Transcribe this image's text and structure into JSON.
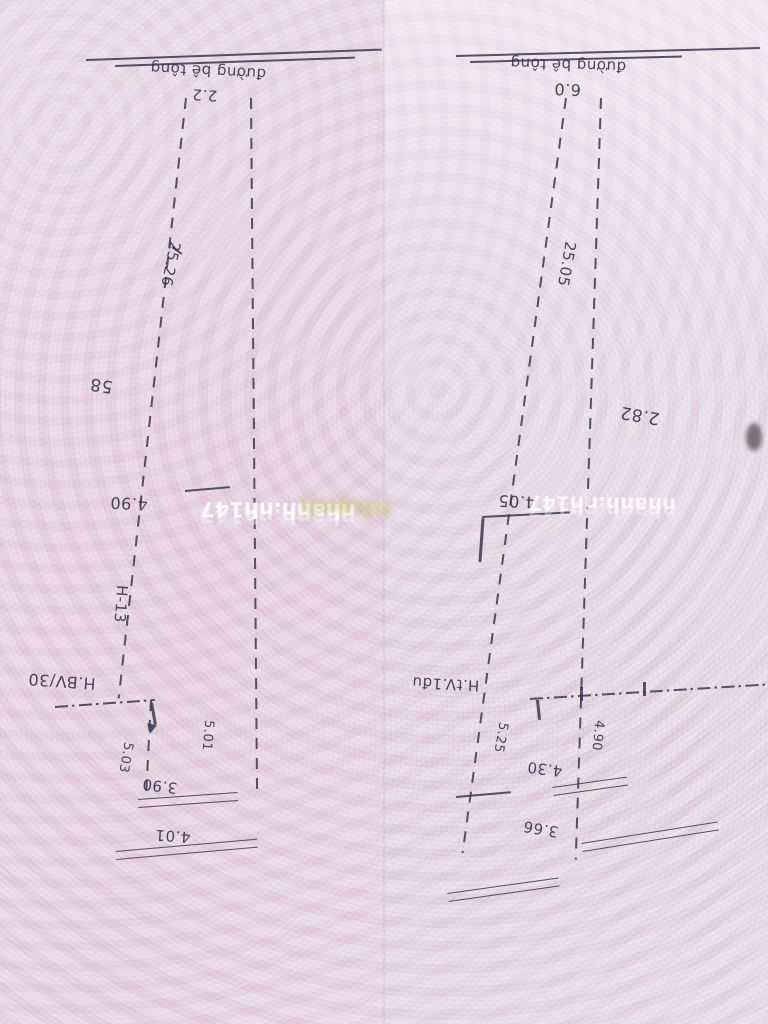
{
  "photo": {
    "paper_color": "#e9dce7",
    "ink_color": "#3a3550",
    "watermark_color": "#ffffff",
    "watermark_left": "nhanh.nh147",
    "watermark_right": "nhanh.nh147",
    "smudge_text": "nhanh"
  },
  "sketch_left": {
    "road_label": "đường bê tông",
    "road_width": "2.2",
    "side_length_left": "25.26",
    "adjacent_parcel": "58",
    "mid_width": "4.90",
    "edge_label": "H-13",
    "boundary_label": "H.BV/30",
    "depth_left": "5.03",
    "depth_right": "5.01",
    "inner_width": "3.90",
    "bottom_width": "4.01"
  },
  "sketch_right": {
    "road_label": "đường bê tông",
    "road_width": "6.0",
    "side_length_left": "25.05",
    "adjacent_parcel": "2.82",
    "mid_width": "4.05",
    "boundary_label": "H.tV.1đu",
    "depth_left": "5.25",
    "depth_right": "4.90",
    "inner_width": "4.30",
    "bottom_width": "3.66"
  }
}
